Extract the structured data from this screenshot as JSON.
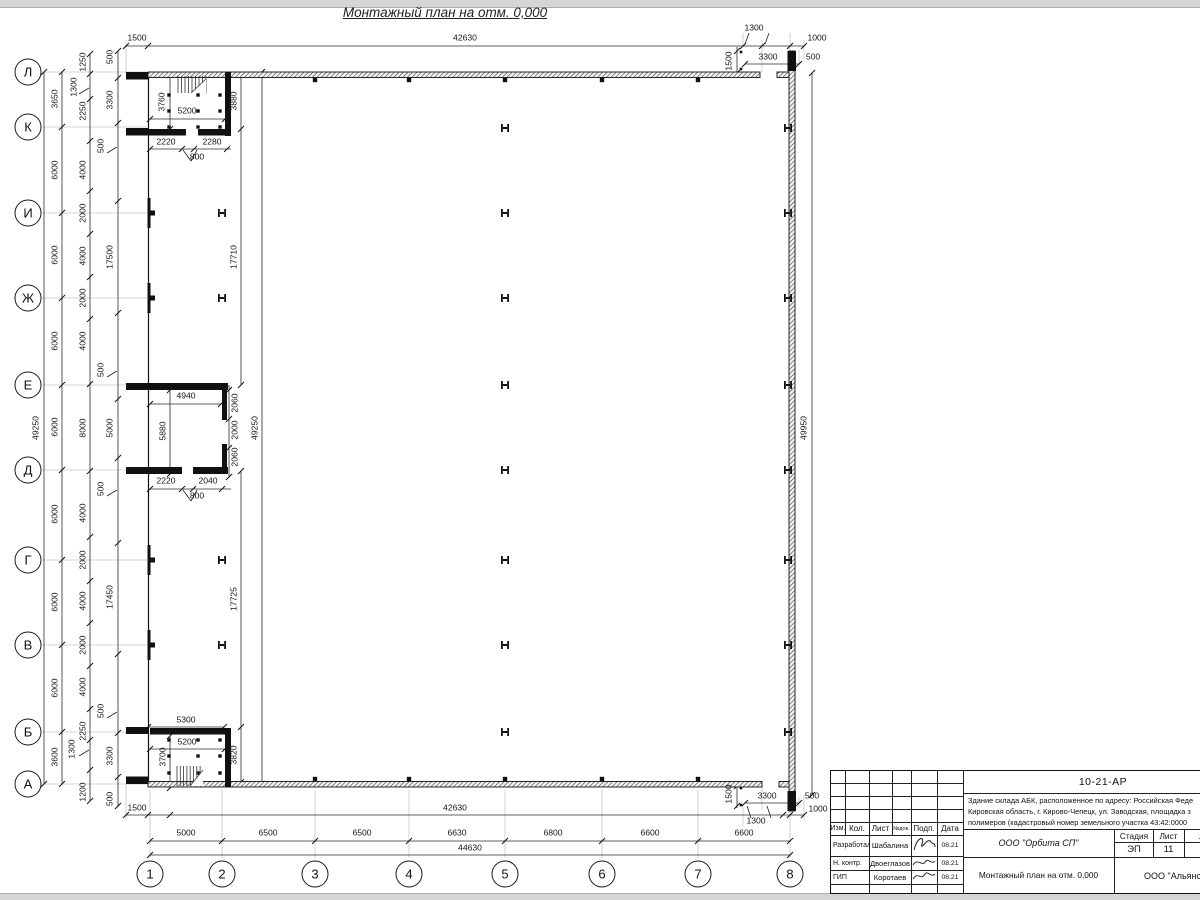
{
  "drawing": {
    "title": "Монтажный план на отм. 0,000",
    "row_axis_labels": [
      "Л",
      "К",
      "И",
      "Ж",
      "Е",
      "Д",
      "Г",
      "В",
      "Б",
      "А"
    ],
    "col_axis_labels": [
      "1",
      "2",
      "3",
      "4",
      "5",
      "6",
      "7",
      "8"
    ],
    "dim_labels": [
      {
        "t": "1500",
        "x": 137,
        "y": 38
      },
      {
        "t": "42630",
        "x": 465,
        "y": 38
      },
      {
        "t": "1300",
        "x": 754,
        "y": 28
      },
      {
        "t": "1000",
        "x": 817,
        "y": 38
      },
      {
        "t": "3300",
        "x": 768,
        "y": 57
      },
      {
        "t": "500",
        "x": 813,
        "y": 57
      },
      {
        "t": "1500",
        "x": 729,
        "y": 61,
        "r": 1
      },
      {
        "t": "49250",
        "x": 36,
        "y": 428,
        "r": 1
      },
      {
        "t": "3650",
        "x": 55,
        "y": 99,
        "r": 1
      },
      {
        "t": "6000",
        "x": 55,
        "y": 170,
        "r": 1
      },
      {
        "t": "6000",
        "x": 55,
        "y": 255,
        "r": 1
      },
      {
        "t": "6000",
        "x": 55,
        "y": 341,
        "r": 1
      },
      {
        "t": "6000",
        "x": 55,
        "y": 427,
        "r": 1
      },
      {
        "t": "6000",
        "x": 55,
        "y": 514,
        "r": 1
      },
      {
        "t": "6000",
        "x": 55,
        "y": 602,
        "r": 1
      },
      {
        "t": "6000",
        "x": 55,
        "y": 688,
        "r": 1
      },
      {
        "t": "3600",
        "x": 55,
        "y": 757,
        "r": 1
      },
      {
        "t": "1250",
        "x": 83,
        "y": 62,
        "r": 1
      },
      {
        "t": "1300",
        "x": 74,
        "y": 87,
        "r": 1
      },
      {
        "t": "2250",
        "x": 83,
        "y": 111,
        "r": 1
      },
      {
        "t": "4000",
        "x": 83,
        "y": 170,
        "r": 1
      },
      {
        "t": "2000",
        "x": 83,
        "y": 213,
        "r": 1
      },
      {
        "t": "4000",
        "x": 83,
        "y": 256,
        "r": 1
      },
      {
        "t": "2000",
        "x": 83,
        "y": 298,
        "r": 1
      },
      {
        "t": "4000",
        "x": 83,
        "y": 341,
        "r": 1
      },
      {
        "t": "8000",
        "x": 83,
        "y": 428,
        "r": 1
      },
      {
        "t": "4000",
        "x": 83,
        "y": 513,
        "r": 1
      },
      {
        "t": "2000",
        "x": 83,
        "y": 560,
        "r": 1
      },
      {
        "t": "4000",
        "x": 83,
        "y": 601,
        "r": 1
      },
      {
        "t": "2000",
        "x": 83,
        "y": 645,
        "r": 1
      },
      {
        "t": "4000",
        "x": 83,
        "y": 687,
        "r": 1
      },
      {
        "t": "2250",
        "x": 83,
        "y": 731,
        "r": 1
      },
      {
        "t": "1300",
        "x": 72,
        "y": 749,
        "r": 1
      },
      {
        "t": "1200",
        "x": 83,
        "y": 792,
        "r": 1
      },
      {
        "t": "500",
        "x": 110,
        "y": 57,
        "r": 1
      },
      {
        "t": "3300",
        "x": 110,
        "y": 100,
        "r": 1
      },
      {
        "t": "500",
        "x": 101,
        "y": 146,
        "r": 1
      },
      {
        "t": "17500",
        "x": 110,
        "y": 257,
        "r": 1
      },
      {
        "t": "500",
        "x": 101,
        "y": 370,
        "r": 1
      },
      {
        "t": "5000",
        "x": 110,
        "y": 428,
        "r": 1
      },
      {
        "t": "500",
        "x": 101,
        "y": 489,
        "r": 1
      },
      {
        "t": "17450",
        "x": 110,
        "y": 597,
        "r": 1
      },
      {
        "t": "500",
        "x": 101,
        "y": 711,
        "r": 1
      },
      {
        "t": "3300",
        "x": 110,
        "y": 756,
        "r": 1
      },
      {
        "t": "500",
        "x": 110,
        "y": 799,
        "r": 1
      },
      {
        "t": "3880",
        "x": 234,
        "y": 101,
        "r": 1
      },
      {
        "t": "17710",
        "x": 234,
        "y": 257,
        "r": 1
      },
      {
        "t": "17725",
        "x": 234,
        "y": 599,
        "r": 1
      },
      {
        "t": "3820",
        "x": 234,
        "y": 755,
        "r": 1
      },
      {
        "t": "49250",
        "x": 255,
        "y": 428,
        "r": 1
      },
      {
        "t": "49950",
        "x": 804,
        "y": 428,
        "r": 1
      },
      {
        "t": "1500",
        "x": 729,
        "y": 794,
        "r": 1
      },
      {
        "t": "3760",
        "x": 162,
        "y": 102,
        "r": 1
      },
      {
        "t": "5200",
        "x": 187,
        "y": 111
      },
      {
        "t": "2220",
        "x": 166,
        "y": 142
      },
      {
        "t": "2280",
        "x": 212,
        "y": 142
      },
      {
        "t": "800",
        "x": 197,
        "y": 157
      },
      {
        "t": "4940",
        "x": 186,
        "y": 396
      },
      {
        "t": "5880",
        "x": 163,
        "y": 431,
        "r": 1
      },
      {
        "t": "2060",
        "x": 235,
        "y": 403,
        "r": 1
      },
      {
        "t": "2000",
        "x": 235,
        "y": 430,
        "r": 1
      },
      {
        "t": "2060",
        "x": 235,
        "y": 457,
        "r": 1
      },
      {
        "t": "2220",
        "x": 166,
        "y": 481
      },
      {
        "t": "2040",
        "x": 208,
        "y": 481
      },
      {
        "t": "800",
        "x": 197,
        "y": 496
      },
      {
        "t": "5300",
        "x": 186,
        "y": 720
      },
      {
        "t": "5200",
        "x": 187,
        "y": 742
      },
      {
        "t": "3700",
        "x": 163,
        "y": 757,
        "r": 1
      },
      {
        "t": "1500",
        "x": 137,
        "y": 808
      },
      {
        "t": "42630",
        "x": 455,
        "y": 808
      },
      {
        "t": "3300",
        "x": 767,
        "y": 796
      },
      {
        "t": "500",
        "x": 812,
        "y": 796
      },
      {
        "t": "1000",
        "x": 818,
        "y": 809
      },
      {
        "t": "1300",
        "x": 756,
        "y": 821
      },
      {
        "t": "5000",
        "x": 186,
        "y": 833
      },
      {
        "t": "6500",
        "x": 268,
        "y": 833
      },
      {
        "t": "6500",
        "x": 362,
        "y": 833
      },
      {
        "t": "6630",
        "x": 457,
        "y": 833
      },
      {
        "t": "6800",
        "x": 553,
        "y": 833
      },
      {
        "t": "6600",
        "x": 650,
        "y": 833
      },
      {
        "t": "6600",
        "x": 744,
        "y": 833
      },
      {
        "t": "44630",
        "x": 470,
        "y": 848
      }
    ]
  },
  "title_block": {
    "doc_code": "10-21-АР",
    "desc": [
      "Здание склада АБК, расположенное по адресу: Российская Феде",
      "Кировская область, г. Кирово-Чепецк, ул. Заводская, площадка з",
      "полимеров (кадастровый номер земельного участка 43:42:0000"
    ],
    "columns": [
      "Изм.",
      "Кол.",
      "Лист",
      "№док.",
      "Подп.",
      "Дата"
    ],
    "rows": [
      {
        "role": "Разработал",
        "name": "Шабалина",
        "date": "08.21"
      },
      {
        "role": "Н. контр.",
        "name": "Двоеглазов",
        "date": "08.21"
      },
      {
        "role": "ГИП",
        "name": "Коротаев",
        "date": "08.21"
      }
    ],
    "org": "ООО \"Орбита СП\"",
    "stage_label": "Стадия",
    "sheet_label": "Лист",
    "sheets_label": "Ли",
    "stage": "ЭП",
    "sheet_no": "11",
    "sheets_no": "1",
    "plan_name": "Монтажный план на отм. 0,000",
    "company": "ООО \"Альянс"
  }
}
